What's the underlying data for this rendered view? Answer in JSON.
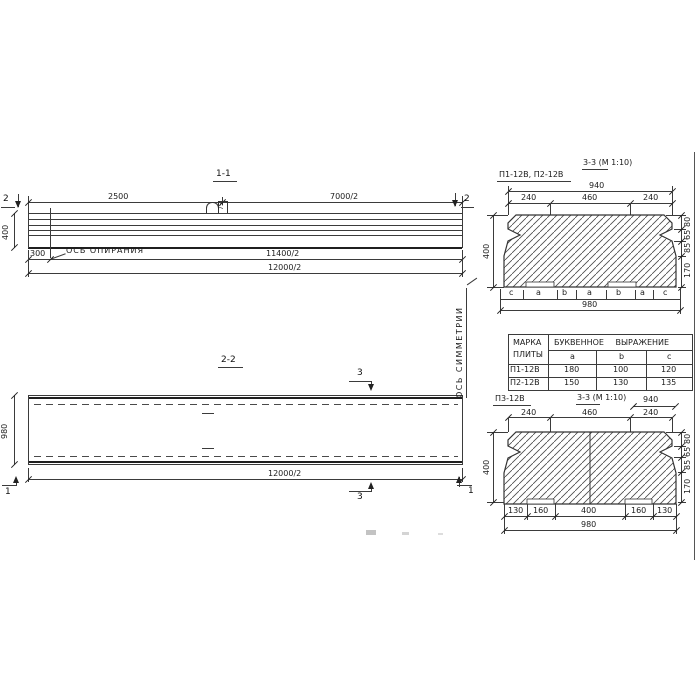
{
  "d": {
    "s11": {
      "title": "1-1",
      "marker": "2",
      "dim_a": "2500",
      "dim_b": "7000/2",
      "height": "400",
      "offset": "300",
      "axis": "ОСЬ ОПИРАНИЯ",
      "span_inner": "11400/2",
      "span_outer": "12000/2",
      "loop": "75"
    },
    "s22": {
      "title": "2-2",
      "marker3": "3",
      "marker1": "1",
      "width": "980",
      "span": "12000/2",
      "sym": "ОСЬ СИММЕТРИИ"
    },
    "s33a": {
      "marks": "П1-12В, П2-12В",
      "title": "3-3 (М 1:10)",
      "top": "940",
      "dims": [
        "240",
        "460",
        "240"
      ],
      "height": "400",
      "side": [
        "80",
        "65",
        "85",
        "170"
      ],
      "letters": [
        "c",
        "a",
        "b",
        "a",
        "b",
        "a",
        "c"
      ],
      "bottom": "980"
    },
    "table": {
      "h1a": "МАРКА",
      "h1b": "ПЛИТЫ",
      "h2": "БУКВЕННОЕ ВЫРАЖЕНИЕ",
      "cols": [
        "a",
        "b",
        "c"
      ],
      "rows": [
        {
          "mark": "П1-12В",
          "a": "180",
          "b": "100",
          "c": "120"
        },
        {
          "mark": "П2-12В",
          "a": "150",
          "b": "130",
          "c": "135"
        }
      ]
    },
    "s33b": {
      "mark": "П3-12В",
      "title": "3-3 (М 1:10)",
      "top": "940",
      "dims": [
        "240",
        "460",
        "240"
      ],
      "height": "400",
      "side": [
        "80",
        "65",
        "85",
        "170"
      ],
      "bottom_dims": [
        "130",
        "160",
        "400",
        "160",
        "130"
      ],
      "bottom": "980"
    }
  }
}
